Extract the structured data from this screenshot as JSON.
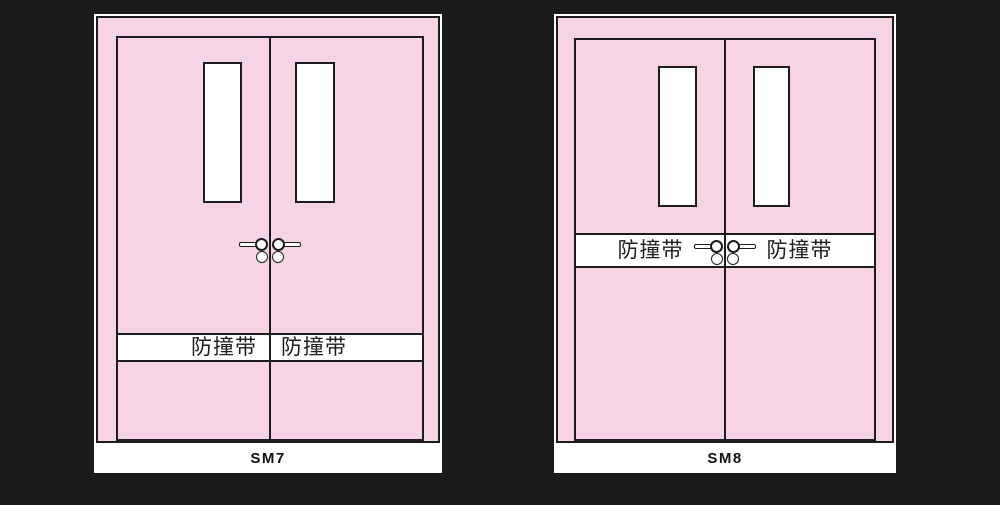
{
  "colors": {
    "background": "#1a191b",
    "door_pink": "#f7d4e4",
    "line": "#1c1c1c",
    "white": "#ffffff"
  },
  "doors": [
    {
      "model": "SM7",
      "band_left": "防撞带",
      "band_right": "防撞带"
    },
    {
      "model": "SM8",
      "band_left": "防撞带",
      "band_right": "防撞带"
    }
  ],
  "icons": {
    "door_handle": "lever-handle-with-round-rose",
    "lock_cylinder": "round-cylinder-circle"
  }
}
